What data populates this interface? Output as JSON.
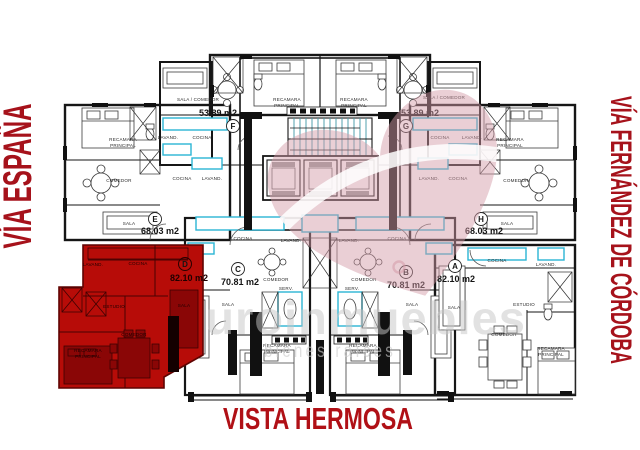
{
  "title": {
    "text": "VISTA HERMOSA"
  },
  "streets": {
    "left": "VÍA ESPAÑA",
    "right": "VÍA FERNÁNDEZ DE CÓRDOBA"
  },
  "watermark": {
    "line1": "euroinmuebles",
    "line2": "bienes raíces"
  },
  "units": {
    "A": {
      "letter": "A",
      "area": "82.10 m2"
    },
    "B": {
      "letter": "B",
      "area": "70.81 m2"
    },
    "C": {
      "letter": "C",
      "area": "70.81 m2"
    },
    "D": {
      "letter": "D",
      "area": "82.10 m2",
      "highlighted": true
    },
    "E": {
      "letter": "E",
      "area": "68.03 m2"
    },
    "F": {
      "letter": "F",
      "area": "53.89 m2"
    },
    "G": {
      "letter": "G",
      "area": "53.89 m2"
    },
    "H": {
      "letter": "H",
      "area": "68.03 m2"
    }
  },
  "rooms": {
    "recamara_line1": "RECAMARA",
    "recamara_line2": "PRINCIPAL",
    "comedor": "COMEDOR",
    "sala": "SALA",
    "cocina": "COCINA",
    "lavand": "LAVAND.",
    "sala_comedor": "SALA / COMEDOR",
    "estudio": "ESTUDIO",
    "serv": "SERV."
  },
  "colors": {
    "street_red": "#a6121b",
    "title_red": "#b01016",
    "highlight_red": "#b70c08",
    "plan_black": "#161616",
    "accent_cyan": "#2ab5d4",
    "stair_teal": "#3f98a6",
    "watermark_pink": "#d49aa8",
    "watermark_gray": "#c7c7c7"
  }
}
